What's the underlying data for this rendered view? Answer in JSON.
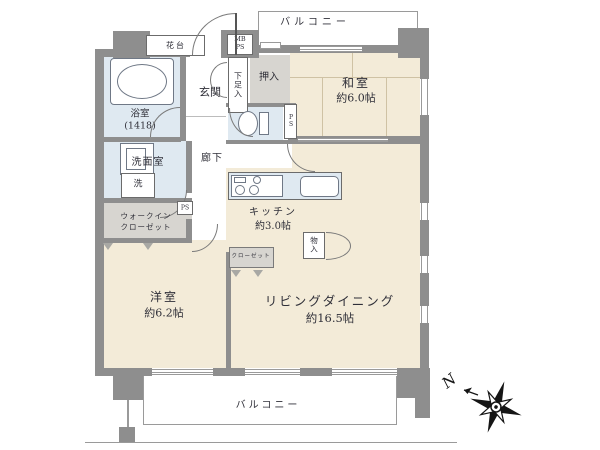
{
  "floorplan": {
    "balcony_top": "バルコニー",
    "balcony_bottom": "バルコニー",
    "compass_n": "N",
    "rooms": {
      "washitsu": {
        "name": "和室",
        "size": "約6.0帖"
      },
      "living": {
        "name": "リビングダイニング",
        "size": "約16.5帖"
      },
      "youshitsu": {
        "name": "洋室",
        "size": "約6.2帖"
      },
      "kitchen": {
        "name": "キッチン",
        "size": "約3.0帖"
      },
      "bath": {
        "name": "浴室",
        "size": "(1418)"
      },
      "washroom": {
        "name": "洗面室"
      },
      "hallway": {
        "name": "廊下"
      },
      "entrance": {
        "name": "玄関"
      }
    },
    "storage": {
      "oshiire": "押入",
      "shoe_box": "下足入",
      "walkin_line1": "ウォークイン",
      "walkin_line2": "クローゼット",
      "closet": "クローゼット",
      "storage_box": "物入",
      "laundry": "洗"
    },
    "utility": {
      "mb": "MB",
      "ps": "PS",
      "flower_stand": "花台"
    },
    "colors": {
      "wall": "#8e8e8e",
      "tatami_room": "#f3ebd8",
      "wet_area": "#dfe9f1",
      "closet": "#d7d5d0"
    }
  }
}
